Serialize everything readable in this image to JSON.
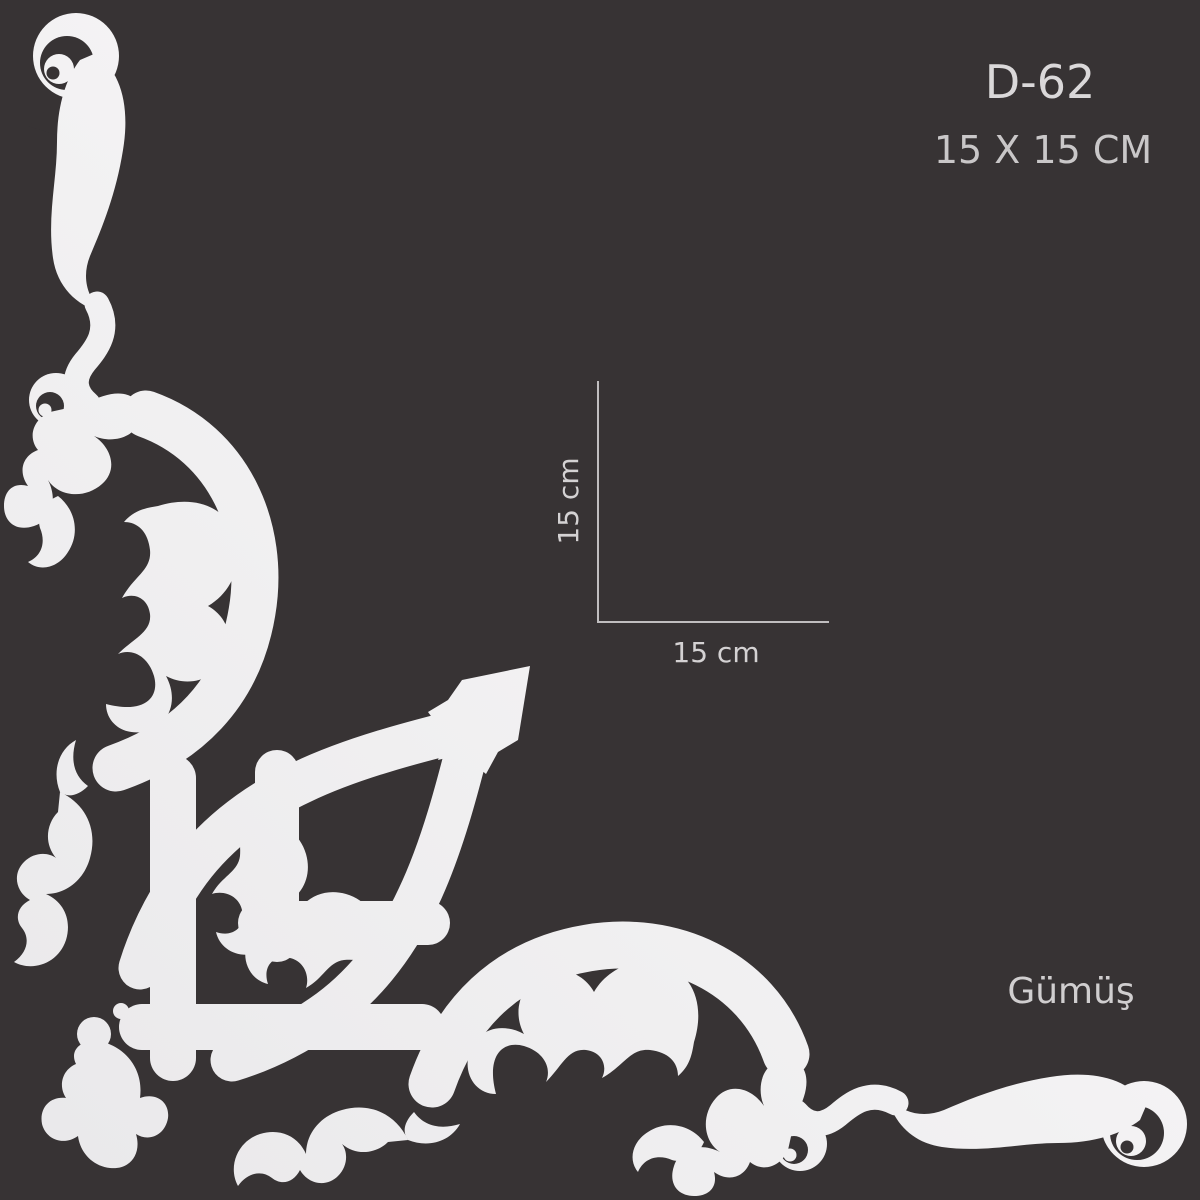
{
  "product": {
    "code": "D-62",
    "size_label": "15 X 15 CM",
    "color_label": "Gümüş"
  },
  "dimensions": {
    "height_label": "15 cm",
    "width_label": "15 cm"
  },
  "graphic": {
    "icon": "baroque-corner-flourish-ornament"
  },
  "colors": {
    "background": "#373334",
    "ornament_light": "#fdfcfd",
    "ornament_dark": "#e9e8ea",
    "text_primary": "#dad8d9",
    "text_secondary": "#c9c7c8",
    "dimension_line": "#c0bebf"
  }
}
